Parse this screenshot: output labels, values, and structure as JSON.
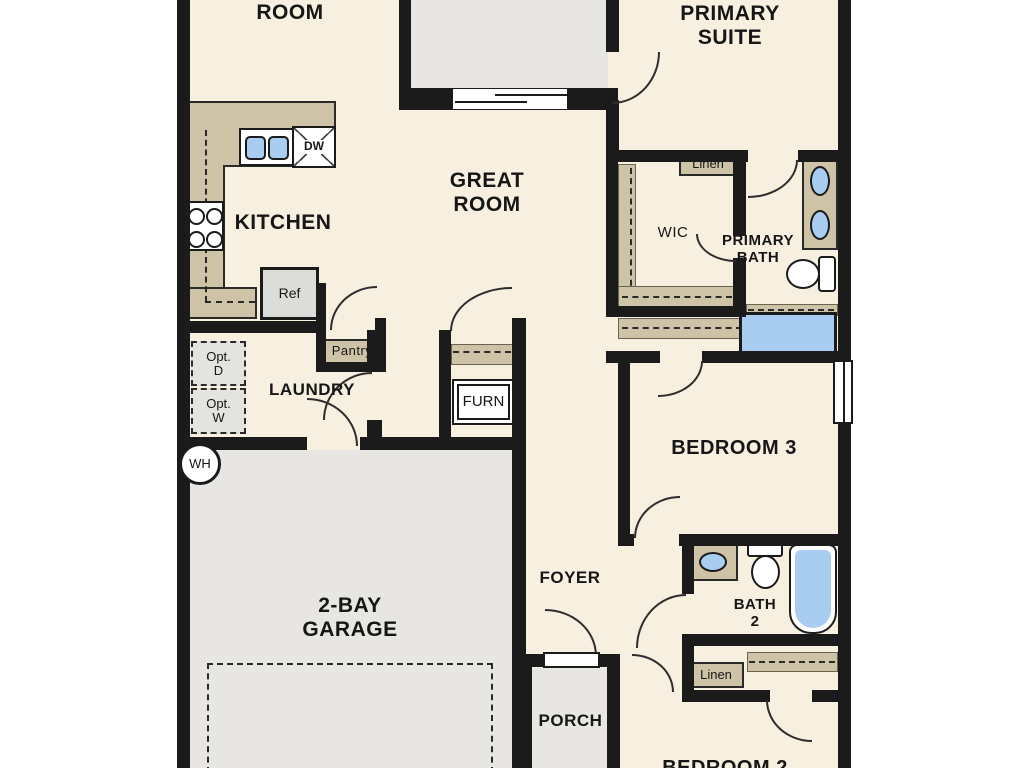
{
  "title": "Single-story floor plan",
  "colors": {
    "wall": "#1b1b1b",
    "floor": "#f7f0e1",
    "hard": "#e7e6e2",
    "counter": "#cfc3a7",
    "water": "#a9cdf0",
    "appliance": "#dcdcd9"
  },
  "rooms": {
    "top_room": "ROOM",
    "primary_suite": "PRIMARY\nSUITE",
    "great_room": "GREAT\nROOM",
    "kitchen": "KITCHEN",
    "laundry": "LAUNDRY",
    "wic": "WIC",
    "primary_bath": "PRIMARY\nBATH",
    "bedroom3": "BEDROOM 3",
    "bath2": "BATH\n2",
    "foyer": "FOYER",
    "garage": "2-BAY\nGARAGE",
    "porch": "PORCH",
    "bedroom2": "BEDROOM 2"
  },
  "labels": {
    "dw": "DW",
    "ref": "Ref",
    "pantry": "Pantry",
    "opt_d": "Opt.\nD",
    "opt_w": "Opt.\nW",
    "furn": "FURN",
    "wh": "WH",
    "linen_upper": "Linen",
    "linen_lower": "Linen"
  }
}
